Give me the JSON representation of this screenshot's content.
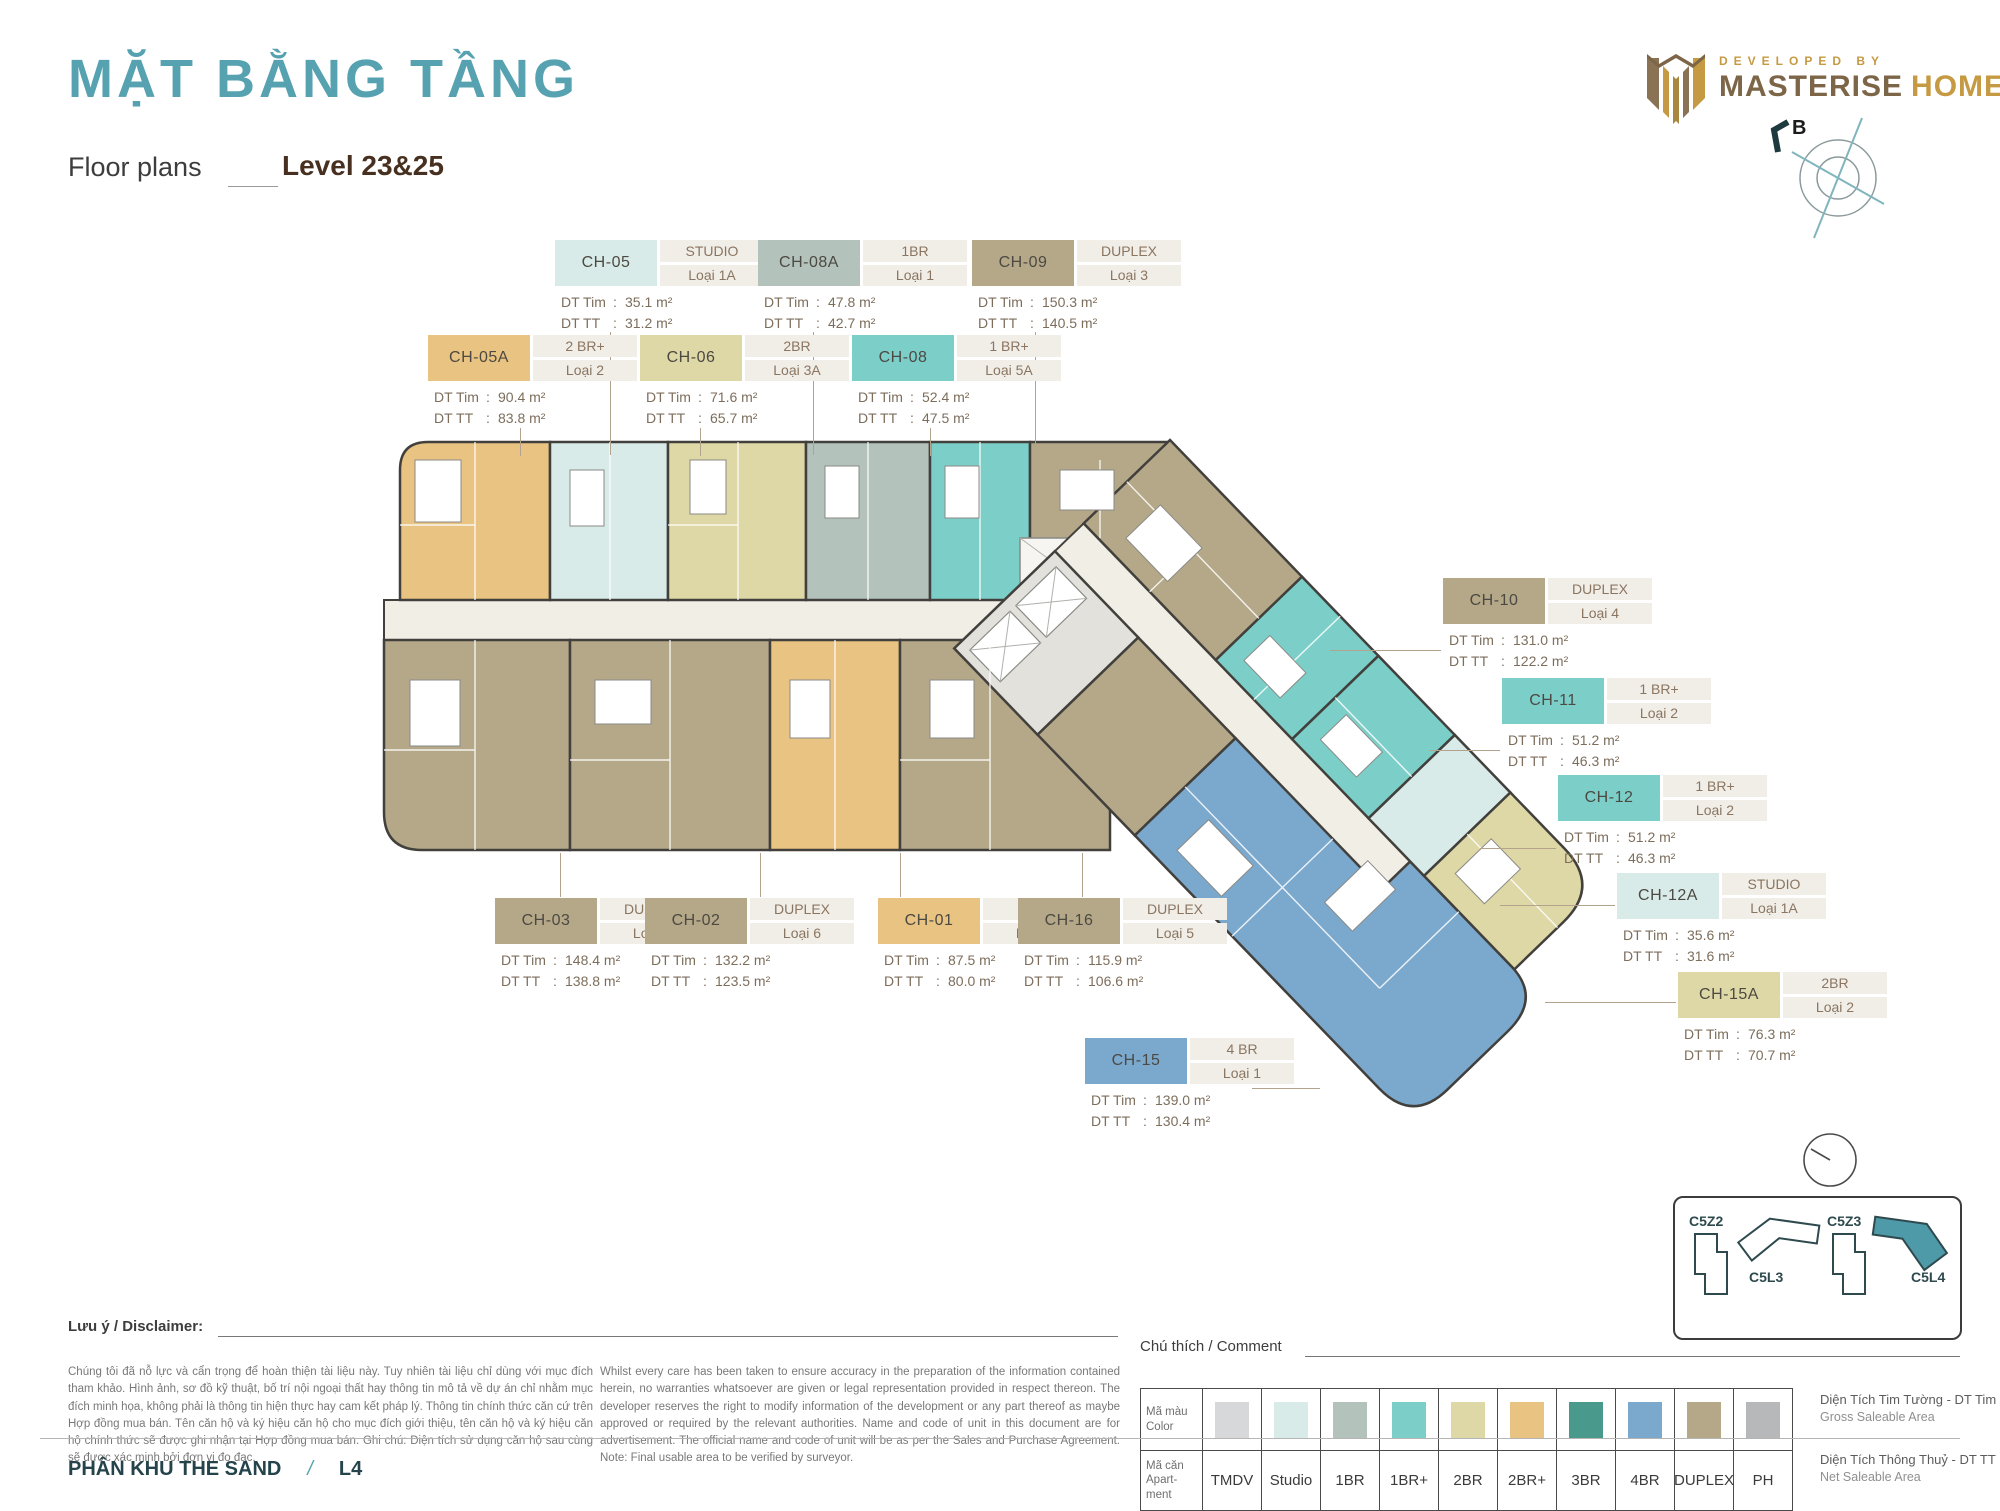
{
  "header": {
    "title_vi": "MẶT BẰNG TẦNG",
    "title_en": "Floor plans",
    "level": "Level 23&25",
    "developer_tagline": "DEVELOPED BY",
    "developer_brand_1": "MASTERISE",
    "developer_brand_2": "HOMES",
    "compass_label": "B"
  },
  "labels": {
    "dt_tim": "DT Tim",
    "dt_tt": "DT TT"
  },
  "units": [
    {
      "code": "CH-05",
      "color": "#d9ebe8",
      "type": "STUDIO",
      "variant": "Loại 1A",
      "dt_tim": "35.1 m²",
      "dt_tt": "31.2 m²"
    },
    {
      "code": "CH-08A",
      "color": "#b3c3bc",
      "type": "1BR",
      "variant": "Loại 1",
      "dt_tim": "47.8 m²",
      "dt_tt": "42.7 m²"
    },
    {
      "code": "CH-09",
      "color": "#b4a888",
      "type": "DUPLEX",
      "variant": "Loại 3",
      "dt_tim": "150.3 m²",
      "dt_tt": "140.5 m²"
    },
    {
      "code": "CH-05A",
      "color": "#e9c381",
      "type": "2 BR+",
      "variant": "Loại 2",
      "dt_tim": "90.4 m²",
      "dt_tt": "83.8 m²"
    },
    {
      "code": "CH-06",
      "color": "#ded7a6",
      "type": "2BR",
      "variant": "Loại 3A",
      "dt_tim": "71.6 m²",
      "dt_tt": "65.7 m²"
    },
    {
      "code": "CH-08",
      "color": "#7ccfc8",
      "type": "1 BR+",
      "variant": "Loại 5A",
      "dt_tim": "52.4 m²",
      "dt_tt": "47.5 m²"
    },
    {
      "code": "CH-10",
      "color": "#b4a888",
      "type": "DUPLEX",
      "variant": "Loại 4",
      "dt_tim": "131.0 m²",
      "dt_tt": "122.2 m²"
    },
    {
      "code": "CH-11",
      "color": "#7ccfc8",
      "type": "1 BR+",
      "variant": "Loại 2",
      "dt_tim": "51.2 m²",
      "dt_tt": "46.3 m²"
    },
    {
      "code": "CH-12",
      "color": "#7ccfc8",
      "type": "1 BR+",
      "variant": "Loại 2",
      "dt_tim": "51.2 m²",
      "dt_tt": "46.3 m²"
    },
    {
      "code": "CH-12A",
      "color": "#d9ebe8",
      "type": "STUDIO",
      "variant": "Loại 1A",
      "dt_tim": "35.6 m²",
      "dt_tt": "31.6 m²"
    },
    {
      "code": "CH-15A",
      "color": "#ded7a6",
      "type": "2BR",
      "variant": "Loại 2",
      "dt_tim": "76.3 m²",
      "dt_tt": "70.7 m²"
    },
    {
      "code": "CH-03",
      "color": "#b4a888",
      "type": "DUPLEX",
      "variant": "Loại 1",
      "dt_tim": "148.4 m²",
      "dt_tt": "138.8 m²"
    },
    {
      "code": "CH-02",
      "color": "#b4a888",
      "type": "DUPLEX",
      "variant": "Loại 6",
      "dt_tim": "132.2 m²",
      "dt_tt": "123.5 m²"
    },
    {
      "code": "CH-01",
      "color": "#e9c381",
      "type": "2BR",
      "variant": "Loại 3",
      "dt_tim": "87.5 m²",
      "dt_tt": "80.0 m²"
    },
    {
      "code": "CH-16",
      "color": "#b4a888",
      "type": "DUPLEX",
      "variant": "Loại 5",
      "dt_tim": "115.9 m²",
      "dt_tt": "106.6 m²"
    },
    {
      "code": "CH-15",
      "color": "#7ba8cd",
      "type": "4 BR",
      "variant": "Loại 1",
      "dt_tim": "139.0 m²",
      "dt_tt": "130.4 m²"
    }
  ],
  "legend": {
    "header": "Chú thích / Comment",
    "row1_label": "Mã màu\nColor",
    "row2_label": "Mã căn\nApart-\nment",
    "items": [
      {
        "label": "TMDV",
        "color": "#d7d8d9"
      },
      {
        "label": "Studio",
        "color": "#d9ebe8"
      },
      {
        "label": "1BR",
        "color": "#b3c3bc"
      },
      {
        "label": "1BR+",
        "color": "#7ccfc8"
      },
      {
        "label": "2BR",
        "color": "#ded7a6"
      },
      {
        "label": "2BR+",
        "color": "#e9c381"
      },
      {
        "label": "3BR",
        "color": "#49998d"
      },
      {
        "label": "4BR",
        "color": "#7ba8cd"
      },
      {
        "label": "DUPLEX",
        "color": "#b4a888"
      },
      {
        "label": "PH",
        "color": "#b7b8ba"
      }
    ]
  },
  "area_notes": [
    {
      "vi": "Diện Tích Tim Tường - DT Tim",
      "en": "Gross Saleable Area"
    },
    {
      "vi": "Diện Tích Thông Thuỷ - DT TT",
      "en": "Net Saleable Area"
    }
  ],
  "disclaimer": {
    "header": "Lưu ý / Disclaimer:",
    "vi": "Chúng tôi đã nỗ lực và cẩn trọng để hoàn thiện tài liệu này. Tuy nhiên tài liệu chỉ dùng với mục đích tham khảo. Hình ảnh, sơ đồ kỹ thuật, bố trí nội ngoại thất hay thông tin mô tả về dự án chỉ nhằm mục đích minh họa, không phải là thông tin hiện thực hay cam kết pháp lý. Thông tin chính thức căn cứ trên Hợp đồng mua bán. Tên căn hộ và ký hiệu căn hộ cho mục đích giới thiệu, tên căn hộ và ký hiệu căn hộ chính thức sẽ được ghi nhận tại Hợp đồng mua bán. Ghi chú: Diện tích sử dụng căn hộ sau cùng sẽ được xác minh bởi đơn vị đo đạc.",
    "en": "Whilst every care has been taken to ensure accuracy in the preparation of the information contained herein, no warranties whatsoever are given or legal representation provided in respect thereon. The developer reserves the right to modify information of the development or any part thereof as maybe approved or required by the relevant authorities. Name and code of unit in this document are for advertisement. The official name and code of unit will be as per the Sales and Purchase Agreement. Note: Final usable area to be verified by surveyor."
  },
  "keyplan": {
    "items": [
      {
        "label": "C5Z2",
        "highlight": false
      },
      {
        "label": "C5L3",
        "highlight": false
      },
      {
        "label": "C5Z3",
        "highlight": false
      },
      {
        "label": "C5L4",
        "highlight": true
      }
    ],
    "highlight_color": "#4f9aa8"
  },
  "footer": {
    "zone": "PHÂN KHU THE SAND",
    "slash": "/",
    "level_code": "L4"
  }
}
